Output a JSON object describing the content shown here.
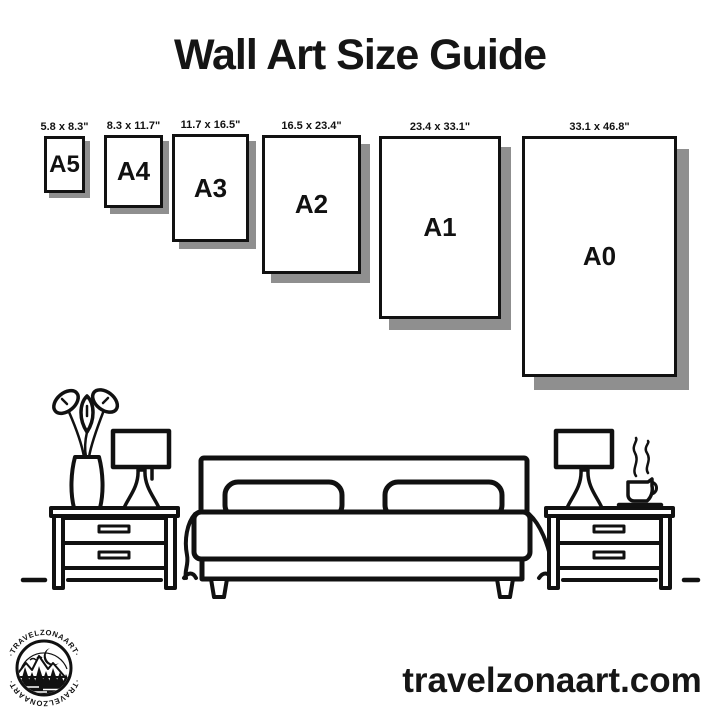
{
  "page": {
    "title": "Wall Art Size Guide",
    "background_color": "#ffffff",
    "ink_color": "#111111",
    "shadow_color": "#8f8f8f"
  },
  "sizes": [
    {
      "name": "A5",
      "dimensions": "5.8 x 8.3\""
    },
    {
      "name": "A4",
      "dimensions": "8.3 x 11.7\""
    },
    {
      "name": "A3",
      "dimensions": "11.7 x 16.5\""
    },
    {
      "name": "A2",
      "dimensions": "16.5 x 23.4\""
    },
    {
      "name": "A1",
      "dimensions": "23.4 x 33.1\""
    },
    {
      "name": "A0",
      "dimensions": "33.1 x 46.8\""
    }
  ],
  "illustration": {
    "icons": [
      "bed-icon",
      "pillow-icon",
      "nightstand-icon",
      "table-lamp-icon",
      "vase-icon",
      "coffee-cup-icon",
      "floor-line"
    ]
  },
  "footer": {
    "website": "travelzonaart.com",
    "logo_text": "TRAVELZONAART",
    "logo_text_decorated": "·TRAVELZONAART·"
  }
}
